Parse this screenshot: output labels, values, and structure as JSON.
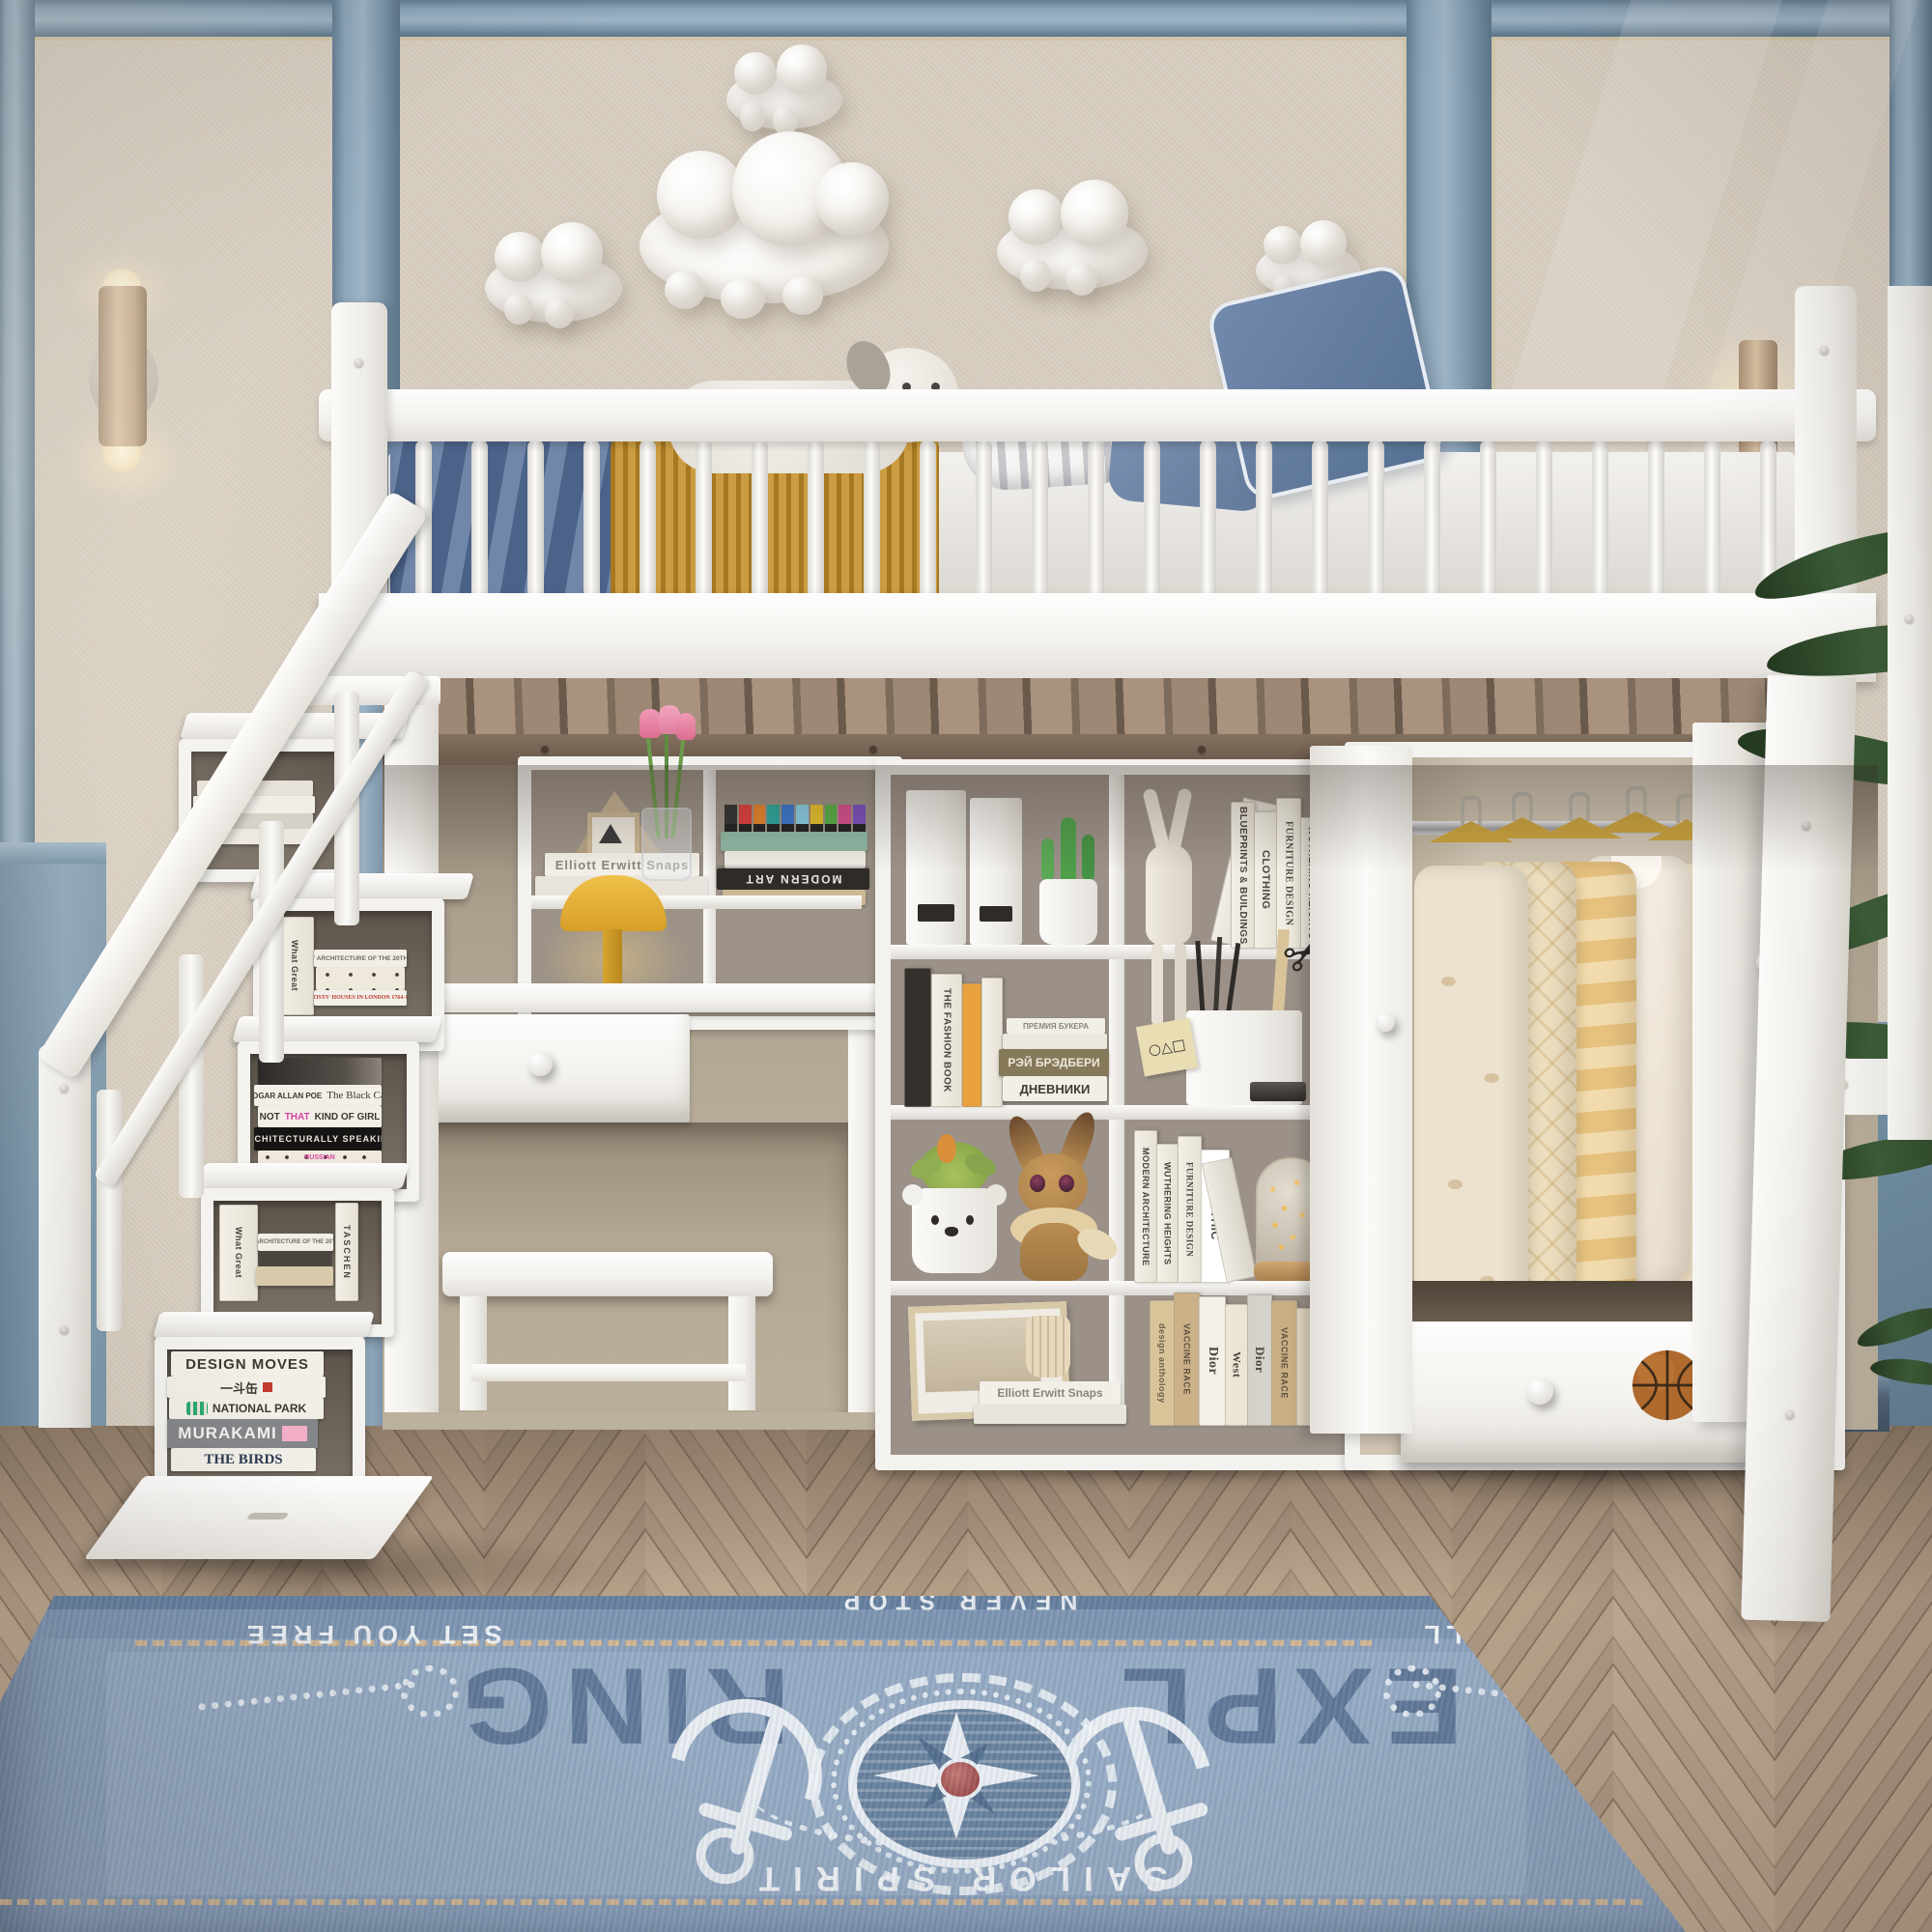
{
  "palette": {
    "wall_beige": "#d7cec0",
    "molding_blue": "#8ba4b8",
    "furniture_white": "#f4f2ee",
    "floor_wood": "#a58f7b",
    "rug_blue": "#8ba1bc",
    "rug_navy": "#5a7494",
    "accent_tan": "#dcba8e",
    "blanket_blue": "#56709a",
    "blanket_gold": "#c08c2a"
  },
  "stairs": {
    "shelf2": {
      "b1a": "What Great",
      "b1b": "Paintings Say",
      "b2": "VISIONARY ARCHITECTURE OF THE 20TH CENTURY",
      "b3": "ARTISTS' HOUSES IN LONDON 1764-1914"
    },
    "shelf3": {
      "poe_author": "EDGAR ALLAN POE",
      "poe_title": "The Black Cat",
      "not1": "NOT",
      "not2": "THAT",
      "not3": "KIND OF GIRL",
      "arch": "ARCHITECTURALLY SPEAKING",
      "rus": "RUSSIAN"
    },
    "shelf4": {
      "b1a": "What Great",
      "b1b": "Paintings Say",
      "b2": "VISIONARY ARCHITECTURE OF THE 20TH CENTURY",
      "taschen": "TASCHEN"
    },
    "shelf5": {
      "b1": "DESIGN MOVES",
      "b2": "一斗缶",
      "b3": "NATIONAL PARK",
      "b4": "MURAKAMI",
      "b5": "THE BIRDS"
    }
  },
  "desk": {
    "elliott": "Elliott Erwitt Snaps",
    "modern_art": "MODERN ART"
  },
  "bookshelf": {
    "row1_books": [
      "BLUEPRINTS & BUILDINGS",
      "CLOTHING",
      "FURNITURE DESIGN",
      "WUTHERING HEIGHTS",
      "MODERN ARCHITECTURE"
    ],
    "row2": {
      "fashion": "THE FASHION BOOK",
      "premiya": "ПРЕМИЯ БУКЕРА",
      "bradbury": "РЭЙ БРЭДБЕРИ",
      "diaries": "ДНЕВНИКИ",
      "sticky": "○△□"
    },
    "row3_books": [
      "MODERN ARCHITECTURE",
      "WUTHERING HEIGHTS",
      "FURNITURE DESIGN",
      "GOTHIC",
      "BLUEPRINTS & BUILDINGS"
    ],
    "row4": {
      "elliott": "Elliott Erwitt Snaps"
    },
    "row4_books": [
      "design anthology",
      "VACCINE RACE",
      "Dior",
      "West",
      "Dior",
      "VACCINE RACE"
    ]
  },
  "rug": {
    "never": "NEVER STOP",
    "expl": "EXPL",
    "ring": "RING",
    "sea": "THE SEA WILL",
    "free": "SET YOU FREE",
    "sailor": "SAILOR SPIRIT"
  }
}
